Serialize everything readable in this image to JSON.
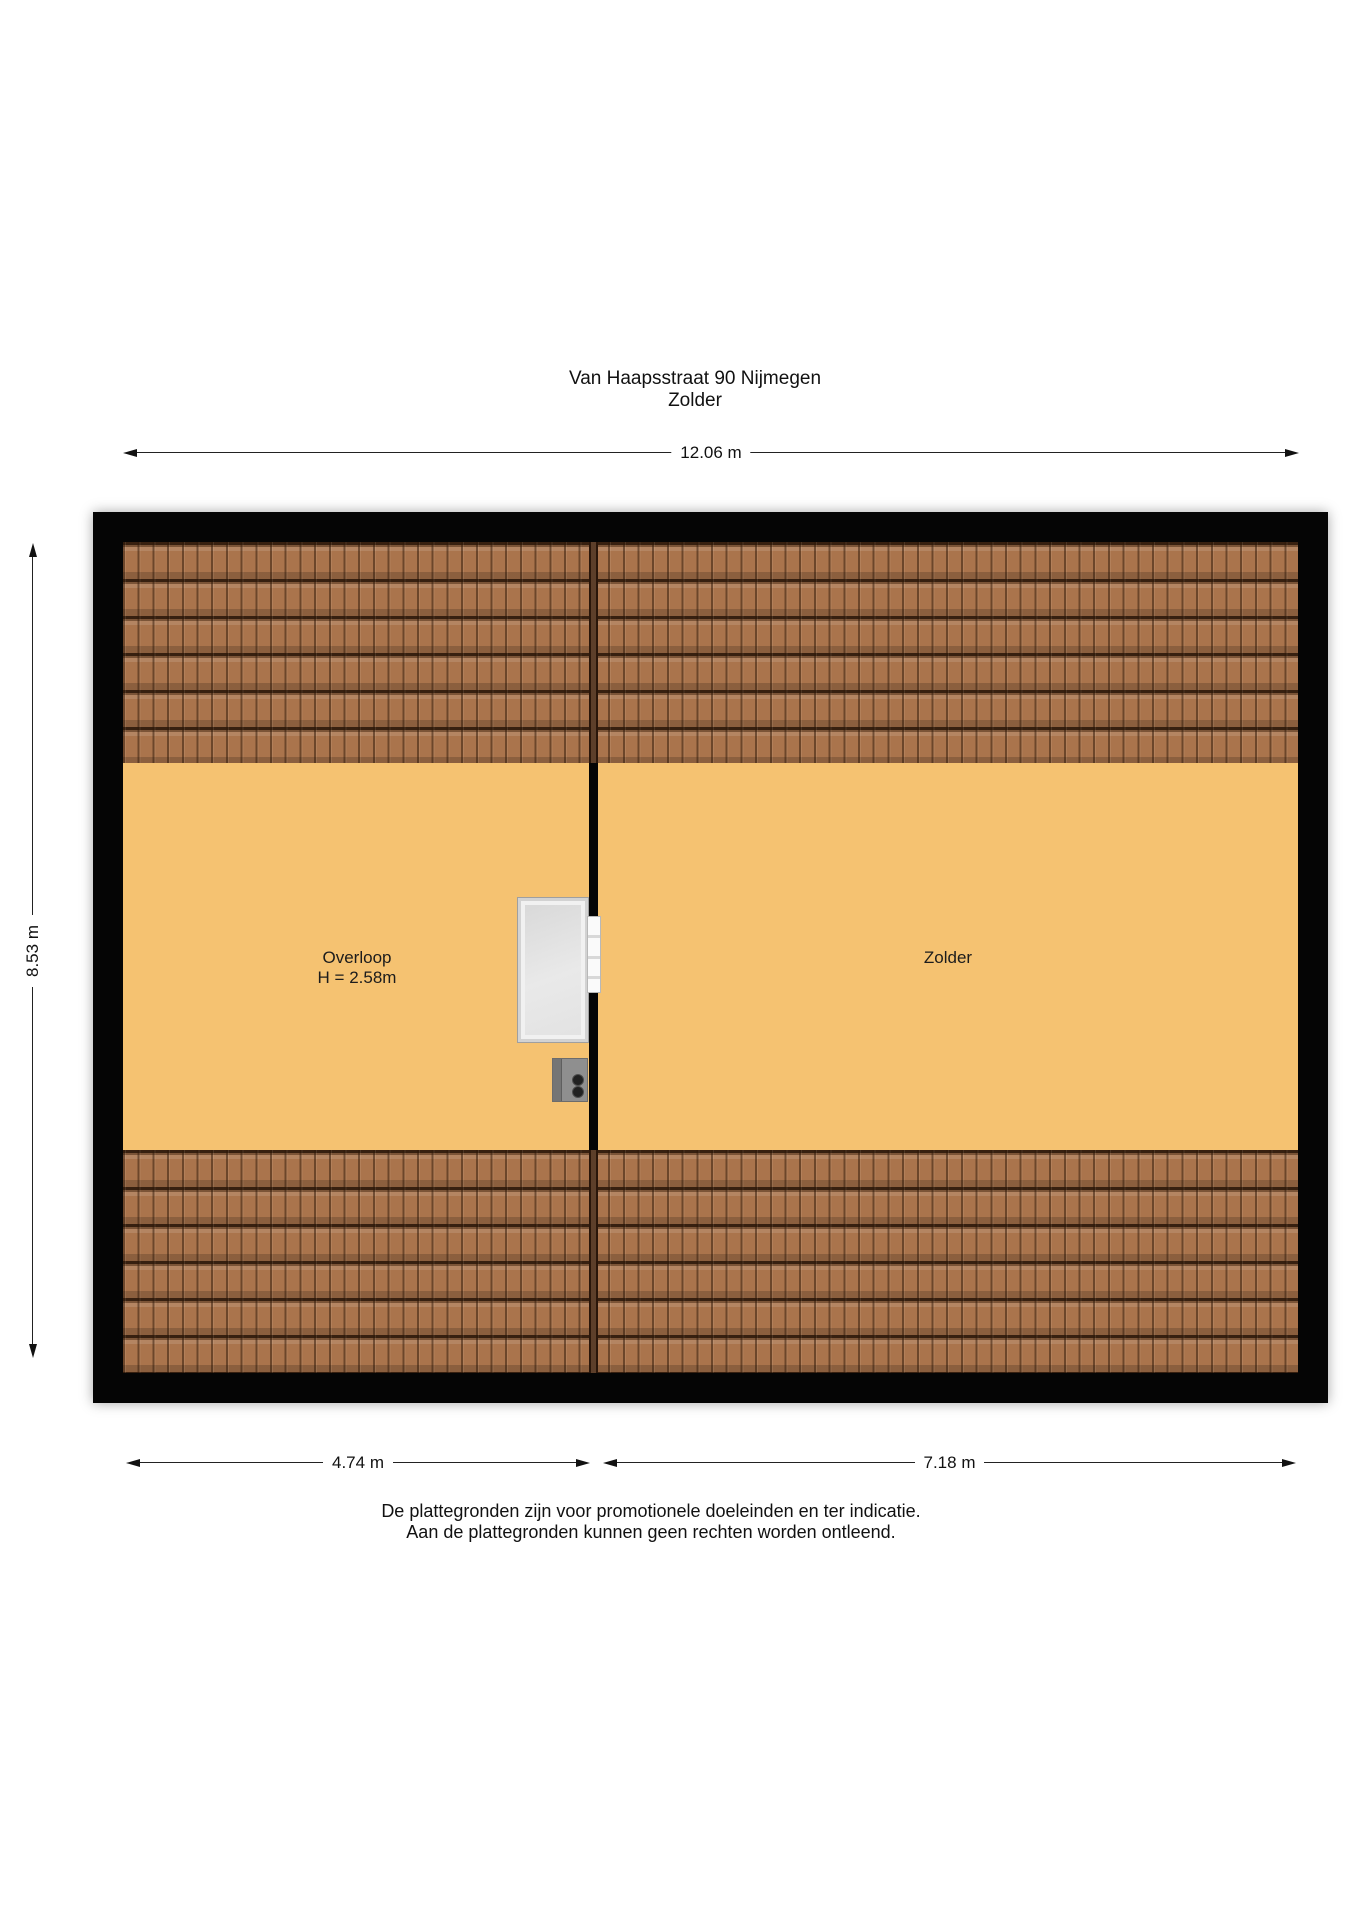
{
  "header": {
    "address": "Van Haapsstraat 90 Nijmegen",
    "floor_name": "Zolder"
  },
  "measurements": {
    "total_width": "12.06 m",
    "total_depth": "8.53 m",
    "overloop_width": "4.74 m",
    "zolder_width": "7.18 m"
  },
  "rooms": {
    "overloop": {
      "label": "Overloop",
      "ceiling_height": "H = 2.58m"
    },
    "zolder": {
      "label": "Zolder"
    }
  },
  "footer": {
    "line1": "De plattegronden zijn voor promotionele doeleinden en ter indicatie.",
    "line2": "Aan de plattegronden kunnen geen rechten worden ontleend."
  },
  "colors": {
    "floor": "#f5c271",
    "roof": "#aa744c",
    "wall": "#050505"
  },
  "elements": {
    "stair_opening": "stair-opening",
    "door": "interior-door",
    "boiler": "boiler-unit"
  }
}
